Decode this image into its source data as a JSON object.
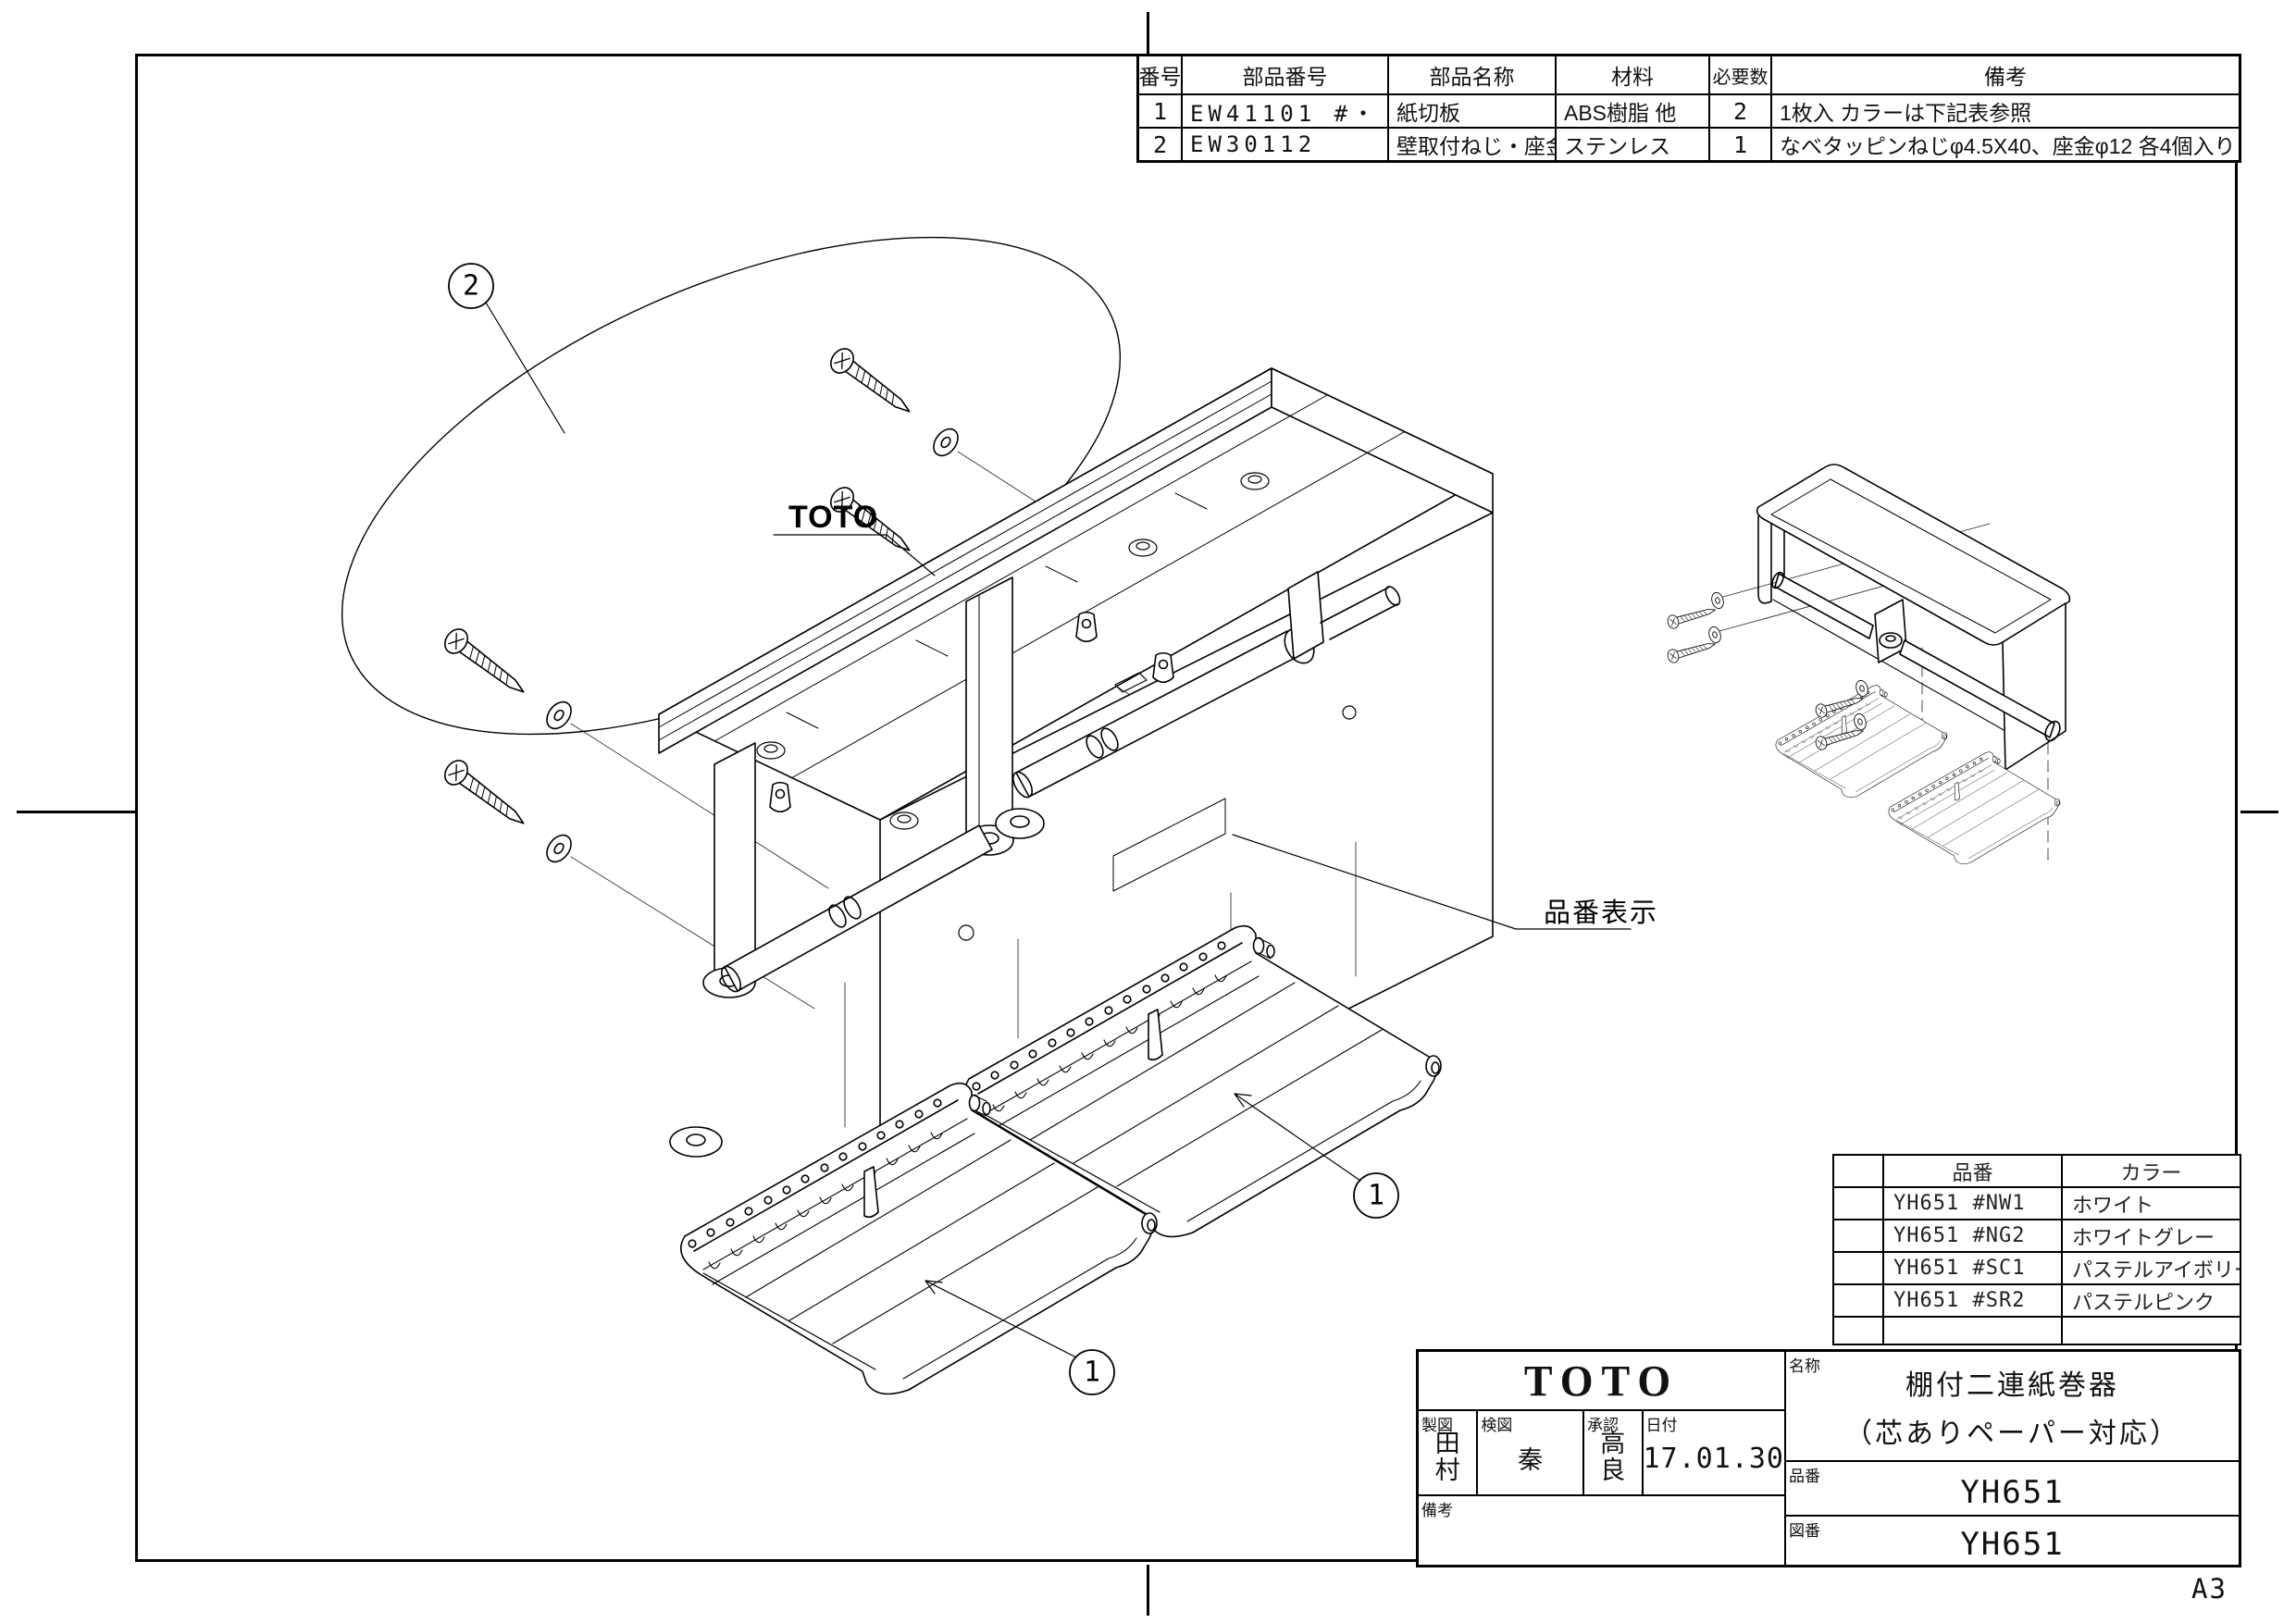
{
  "sheet": {
    "size_label": "A3"
  },
  "parts_table": {
    "headers": [
      "番号",
      "部品番号",
      "部品名称",
      "材料",
      "必要数",
      "備考"
    ],
    "rows": [
      {
        "no": "1",
        "part_number": "EW41101 #・・・",
        "name": "紙切板",
        "material": "ABS樹脂 他",
        "qty": "2",
        "remarks": "1枚入  カラーは下記表参照"
      },
      {
        "no": "2",
        "part_number": "EW30112",
        "name": "壁取付ねじ・座金",
        "material": "ステンレス",
        "qty": "1",
        "remarks": "なべタッピンねじφ4.5X40、座金φ12  各4個入り"
      }
    ]
  },
  "color_table": {
    "headers": [
      "品番",
      "カラー"
    ],
    "rows": [
      {
        "code": "YH651 #NW1",
        "color": "ホワイト"
      },
      {
        "code": "YH651 #NG2",
        "color": "ホワイトグレー"
      },
      {
        "code": "YH651 #SC1",
        "color": "パステルアイボリー"
      },
      {
        "code": "YH651 #SR2",
        "color": "パステルピンク"
      }
    ]
  },
  "title_block": {
    "logo": "TOTO",
    "drafter_label": "製図",
    "drafter": "田村",
    "checker_label": "検図",
    "checker": "秦",
    "approver_label": "承認",
    "approver": "高良",
    "date_label": "日付",
    "date": "17.01.30",
    "remarks_label": "備考",
    "remarks": "",
    "name_label": "名称",
    "product_name_line1": "棚付二連紙巻器",
    "product_name_line2": "（芯ありペーパー対応）",
    "part_no_label": "品番",
    "part_no": "YH651",
    "drawing_no_label": "図番",
    "drawing_no": "YH651"
  },
  "annotations": {
    "product_logo": "TOTO",
    "part_number_display_label": "品番表示",
    "balloons": {
      "screws": "2",
      "cutter_right": "1",
      "cutter_left": "1"
    }
  }
}
